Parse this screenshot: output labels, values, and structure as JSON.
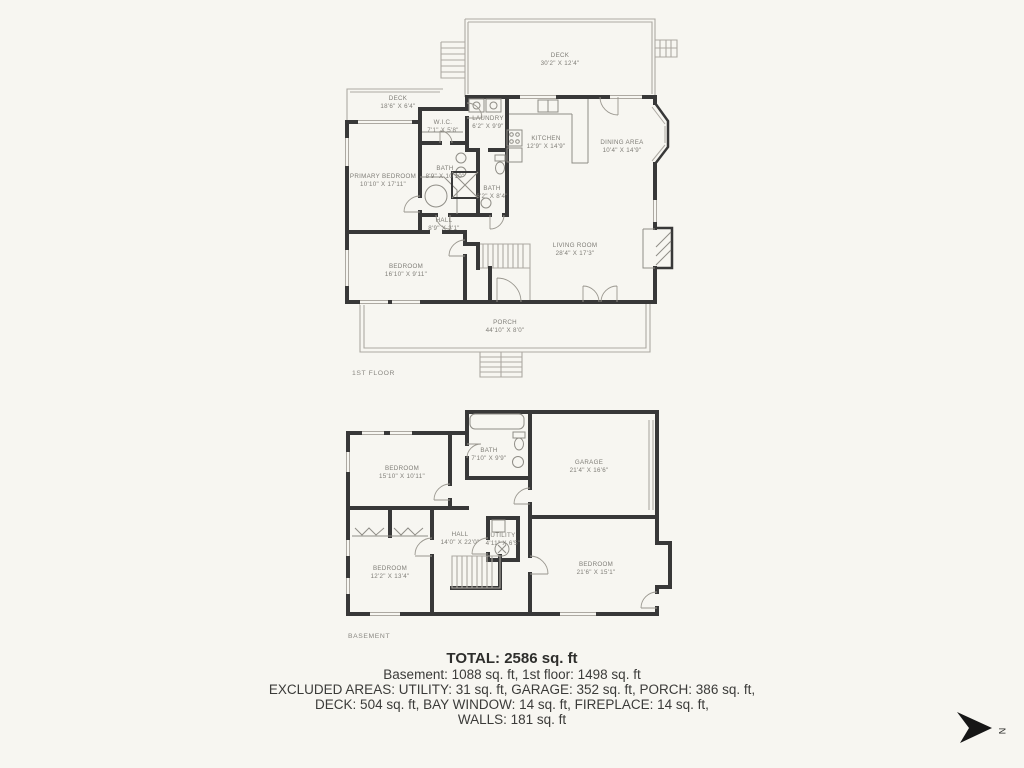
{
  "first_floor": {
    "caption": "1ST FLOOR",
    "rooms": [
      {
        "name": "DECK",
        "dims": "30'2\" X 12'4\""
      },
      {
        "name": "DECK",
        "dims": "18'6\" X 6'4\""
      },
      {
        "name": "W.I.C.",
        "dims": "7'1\" X 5'8\""
      },
      {
        "name": "LAUNDRY",
        "dims": "6'2\" X 9'9\""
      },
      {
        "name": "KITCHEN",
        "dims": "12'9\" X 14'9\""
      },
      {
        "name": "DINING AREA",
        "dims": "10'4\" X 14'9\""
      },
      {
        "name": "PRIMARY BEDROOM",
        "dims": "10'10\" X 17'11\""
      },
      {
        "name": "BATH",
        "dims": "8'9\" X 10'10\""
      },
      {
        "name": "BATH",
        "dims": "6'2\" X 8'4\""
      },
      {
        "name": "HALL",
        "dims": "8'9\" X 3'1\""
      },
      {
        "name": "BEDROOM",
        "dims": "16'10\" X 9'11\""
      },
      {
        "name": "LIVING ROOM",
        "dims": "28'4\" X 17'3\""
      },
      {
        "name": "PORCH",
        "dims": "44'10\" X 8'0\""
      }
    ]
  },
  "basement": {
    "caption": "BASEMENT",
    "rooms": [
      {
        "name": "BEDROOM",
        "dims": "15'10\" X 10'11\""
      },
      {
        "name": "BATH",
        "dims": "7'10\" X 9'9\""
      },
      {
        "name": "GARAGE",
        "dims": "21'4\" X 16'6\""
      },
      {
        "name": "HALL",
        "dims": "14'0\" X 22'0\""
      },
      {
        "name": "UTILITY",
        "dims": "4'11\" X 6'5\""
      },
      {
        "name": "BEDROOM",
        "dims": "12'2\" X 13'4\""
      },
      {
        "name": "BEDROOM",
        "dims": "21'6\" X 15'1\""
      }
    ]
  },
  "summary": {
    "total": "TOTAL: 2586 sq. ft",
    "floors": "Basement: 1088 sq. ft, 1st floor: 1498 sq. ft",
    "excluded1": "EXCLUDED AREAS: UTILITY: 31 sq. ft, GARAGE: 352 sq. ft, PORCH: 386 sq. ft,",
    "excluded2": "DECK: 504 sq. ft, BAY WINDOW: 14 sq. ft, FIREPLACE: 14 sq. ft,",
    "excluded3": "WALLS: 181 sq. ft"
  },
  "compass": {
    "label": "N"
  },
  "colors": {
    "background": "#f7f6f1",
    "wall": "#383838",
    "thin_line": "#ada9a2",
    "room_label": "#7f7d77",
    "summary_text": "#3b3b39"
  }
}
